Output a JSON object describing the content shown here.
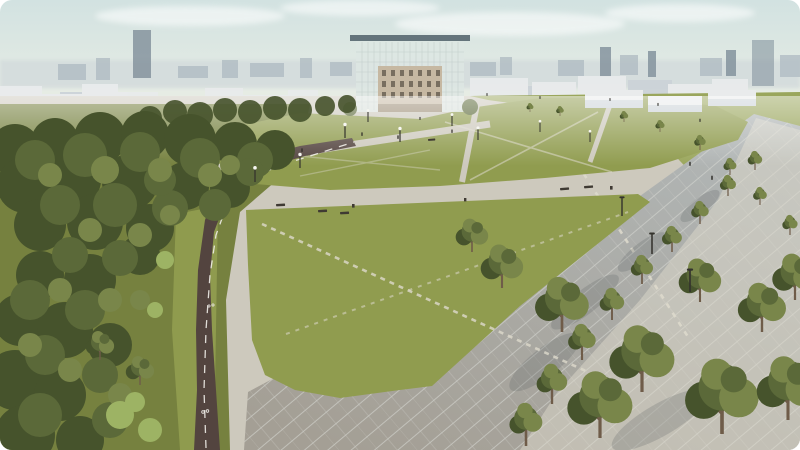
{
  "image": {
    "title": "Aerial architectural rendering of an urban park",
    "description": "Computer-generated bird's-eye rendering of a landscaped park: olive-green lawns crossed by light concrete walkways, a dark curved bike lane with a white dashed centerline, a large grey slab-paved plaza with rows of young trees, dense dark woodland on the left, white schematic city blocks and a hazy skyline with towers in the distance, and a five-storey beige building wrapped in a glass scaffold structure with a flat roof canopy at the top center."
  },
  "scene": {
    "elements": [
      "sky with soft clouds",
      "hazy city skyline",
      "dark high-rise tower",
      "white schematic city blocks",
      "white exhibition pavilions",
      "scaffolded landmark building",
      "upper lawn",
      "central kite-shaped lawn",
      "radiating concrete walkways",
      "dashed desire paths",
      "bike lane with dashed centerline",
      "slab-paved plaza",
      "tree-lined promenade",
      "left woodland",
      "street lamps",
      "benches",
      "pedestrians"
    ]
  },
  "colors": {
    "sky-top": "#d2e2e1",
    "sky-bottom": "#edefe5",
    "haze": "#d4dcdd",
    "skyline": "#aebac1",
    "skyline-dark": "#7f8f9a",
    "city-white": "#e9ebec",
    "city-shadow": "#ccd3d8",
    "glass": "#dde6e3",
    "mullion": "#bcc8c6",
    "roof": "#64747b",
    "facade": "#c6b8a2",
    "facade-dark": "#9f9079",
    "window": "#6b6254",
    "lawn": "#909c4f",
    "lawn-far": "#9aa65c",
    "grass-dark": "#76813f",
    "tree-dark": "#46532c",
    "tree-mid": "#5b6939",
    "tree-light": "#79864a",
    "tree-bright": "#9db364",
    "trunk": "#6f5c49",
    "path": "#cdc9bd",
    "path-light": "#ddd9cc",
    "plaza-top": "#b1b6b6",
    "plaza-bottom": "#a49f95",
    "joint": "#d5d6d1",
    "bike": "#53443f",
    "bike-line": "#f0ede8",
    "shade": "#565c5e",
    "lamp": "#34332d",
    "lamp-head": "#f7f7f2",
    "bench": "#3f3a33",
    "figure": "#2f2d28"
  }
}
